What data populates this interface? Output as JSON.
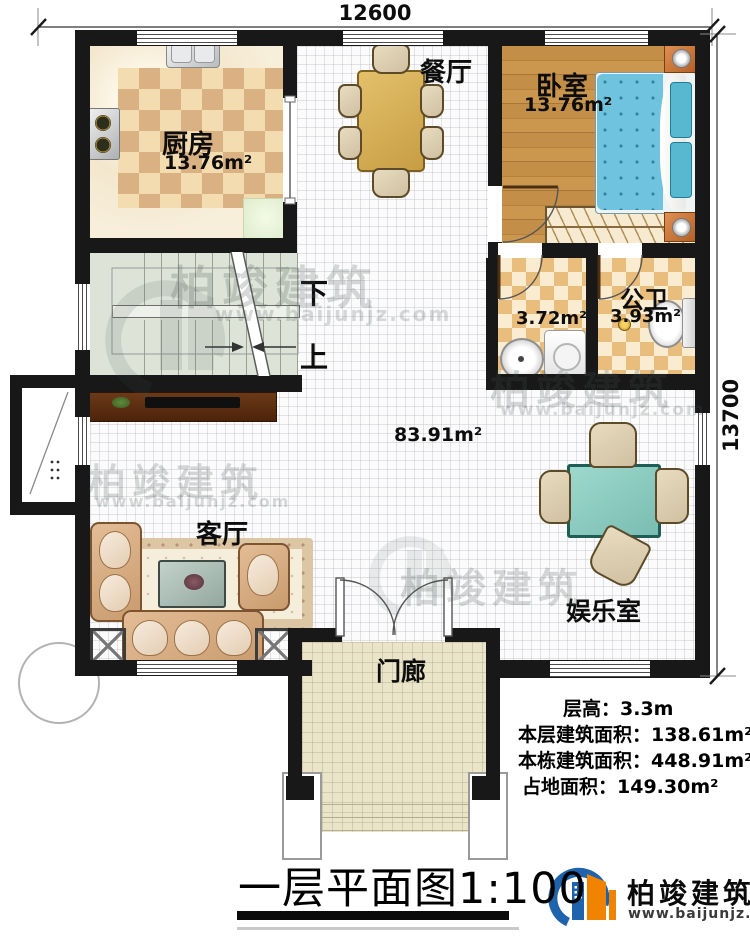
{
  "dims": {
    "top": "12600",
    "right": "13700"
  },
  "rooms": {
    "kitchen": {
      "label": "厨房",
      "area": "13.76m²"
    },
    "dining": {
      "label": "餐厅"
    },
    "bedroom": {
      "label": "卧室",
      "area": "13.76m²"
    },
    "bath_small": {
      "area": "3.72m²"
    },
    "bath_public": {
      "label": "公卫",
      "area": "3.93m²"
    },
    "hall": {
      "area": "83.91m²"
    },
    "living": {
      "label": "客厅"
    },
    "entertainment": {
      "label": "娱乐室"
    },
    "porch": {
      "label": "门廊"
    }
  },
  "stairs": {
    "down": "下",
    "up": "上"
  },
  "stats": {
    "floor_height": {
      "label": "层高：",
      "value": "3.3m"
    },
    "floor_area": {
      "label": "本层建筑面积：",
      "value": "138.61m²"
    },
    "building_area": {
      "label": "本栋建筑面积：",
      "value": "448.91m²"
    },
    "footprint_area": {
      "label": "占地面积：",
      "value": "149.30m²"
    }
  },
  "title": "一层平面图1:100",
  "brand": {
    "name": "柏竣建筑",
    "url": "www.baijunjz.com"
  },
  "colors": {
    "wall": "#181818",
    "brand_blue": "#1f63ad",
    "brand_orange": "#f08300"
  }
}
